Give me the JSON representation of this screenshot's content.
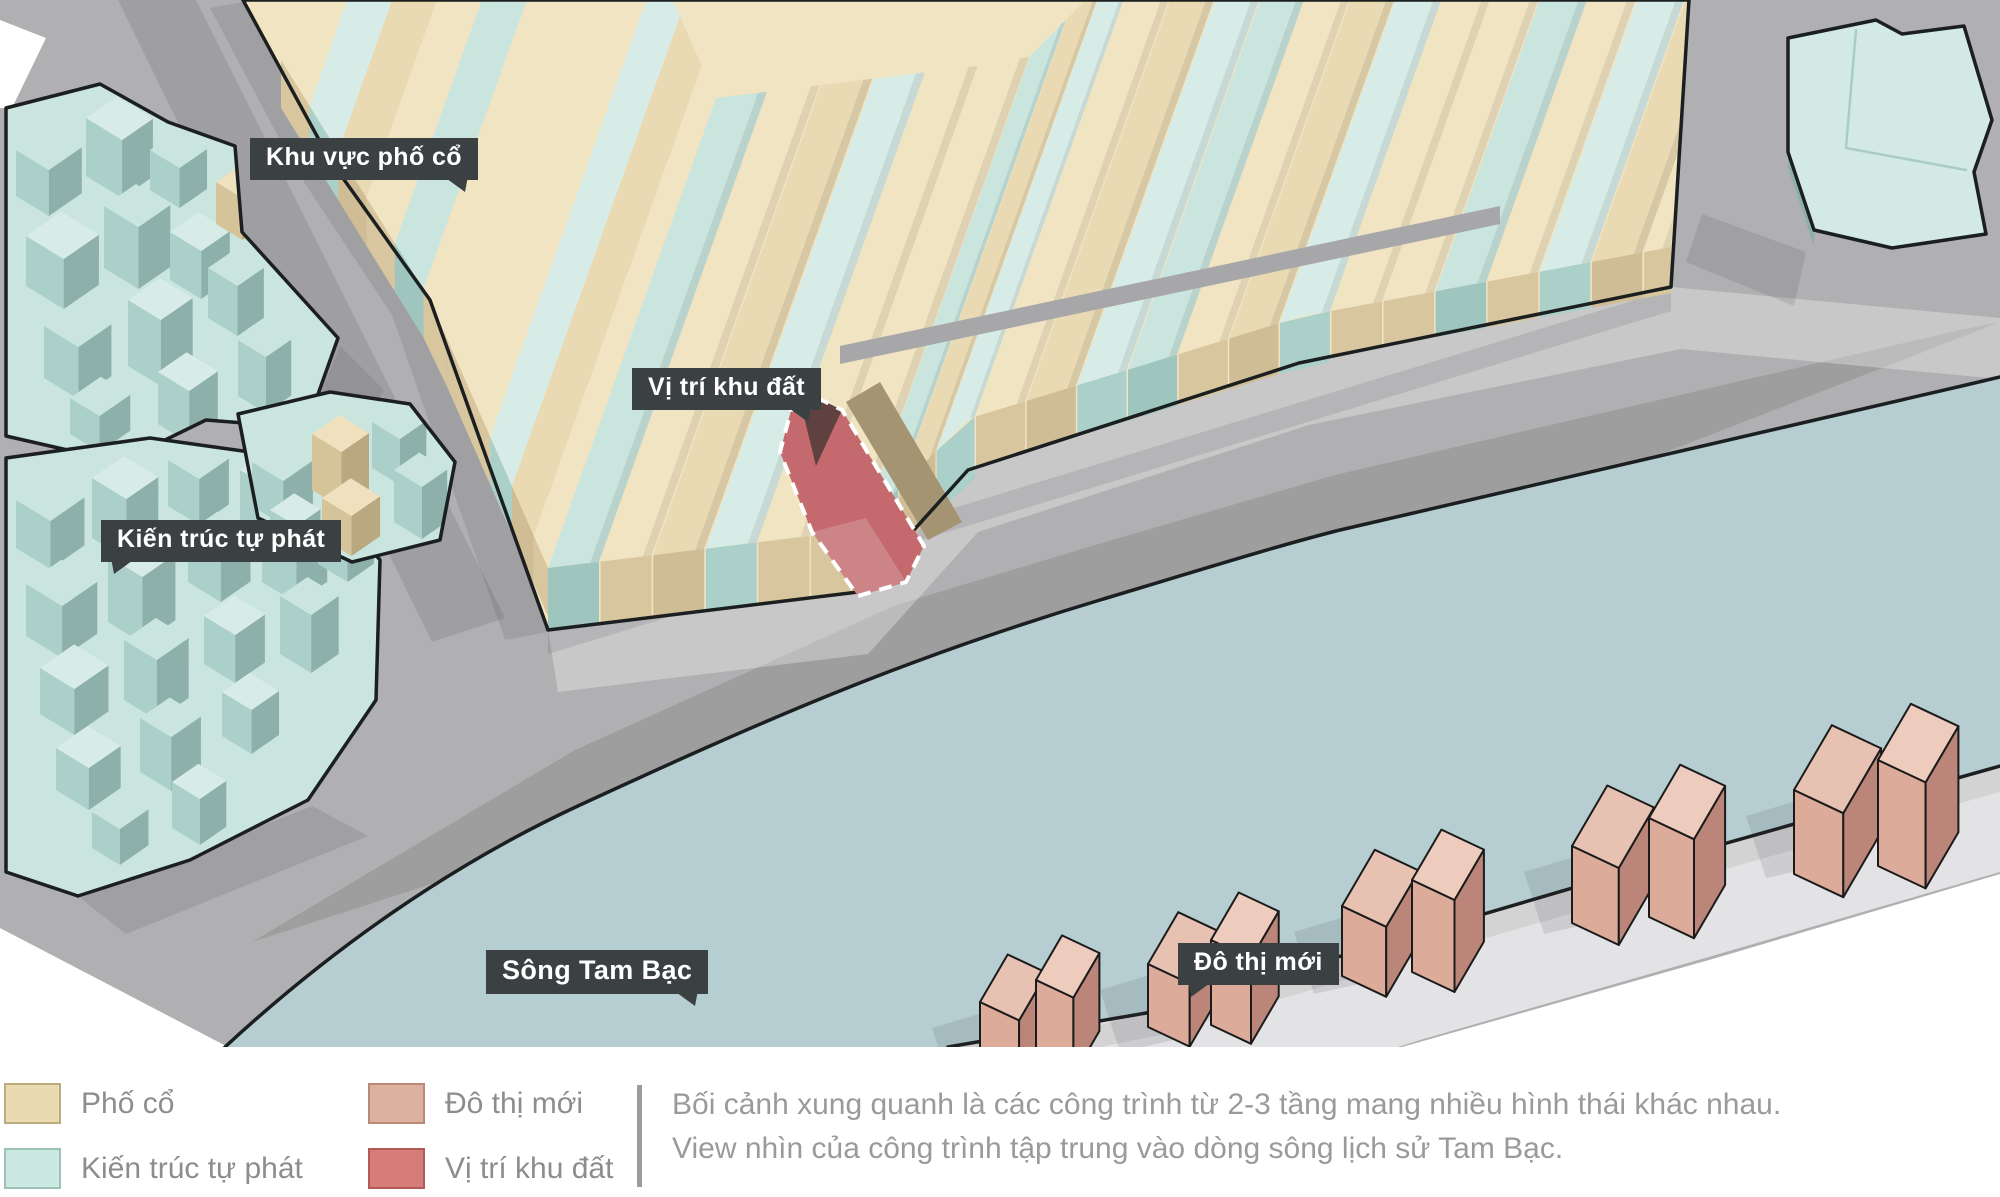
{
  "map": {
    "labels": [
      {
        "id": "old-quarter-area",
        "text": "Khu vực phố cổ"
      },
      {
        "id": "site-location",
        "text": "Vị trí khu đất"
      },
      {
        "id": "informal-architecture",
        "text": "Kiến trúc tự phát"
      },
      {
        "id": "river",
        "text": "Sông Tam Bạc"
      },
      {
        "id": "new-urban",
        "text": "Đô thị mới"
      }
    ]
  },
  "legend": {
    "items": [
      {
        "label": "Phố cổ",
        "color": "#e9dab1",
        "border": "#bcab7d"
      },
      {
        "label": "Kiến trúc tự phát",
        "color": "#cbe8e1",
        "border": "#9cc2b9"
      },
      {
        "label": "Đô thị mới",
        "color": "#dcb1a0",
        "border": "#bb8a77"
      },
      {
        "label": "Vị trí khu đất",
        "color": "#d67d79",
        "border": "#b25a57"
      }
    ]
  },
  "description": {
    "line1": "Bối cảnh xung quanh là các công trình từ 2-3 tầng mang nhiều hình thái khác nhau.",
    "line2": "View nhìn của công trình tập trung vào dòng sông lịch sử Tam Bạc."
  },
  "colors": {
    "background": "#ffffff",
    "road": "#b0b0b2",
    "road_light": "#c9c9cb",
    "river": "#b6ced2",
    "embankment": "#e3e3e5",
    "outline": "#1b1f20",
    "label_bg": "#3b4142",
    "label_text": "#ffffff",
    "legend_text": "#8d8d8d",
    "description_text": "#9a9a9a",
    "old_town_roof": "#f1e4c3",
    "old_town_roof_alt": "#e9dab3",
    "old_town_wall": "#d8c69f",
    "old_town_side": "#a59472",
    "informal_roof": "#d7ece6",
    "informal_roof_alt": "#c9e5de",
    "informal_wall": "#abd0c9",
    "informal_side": "#8db1aa",
    "new_urban_roof": "#eeccbd",
    "new_urban_roof_alt": "#e7c2b2",
    "new_urban_wall": "#dcab9a",
    "new_urban_side": "#bb8679",
    "site_fill": "#c4696d",
    "site_dark": "#5f4140",
    "site_light": "#cd8486"
  }
}
